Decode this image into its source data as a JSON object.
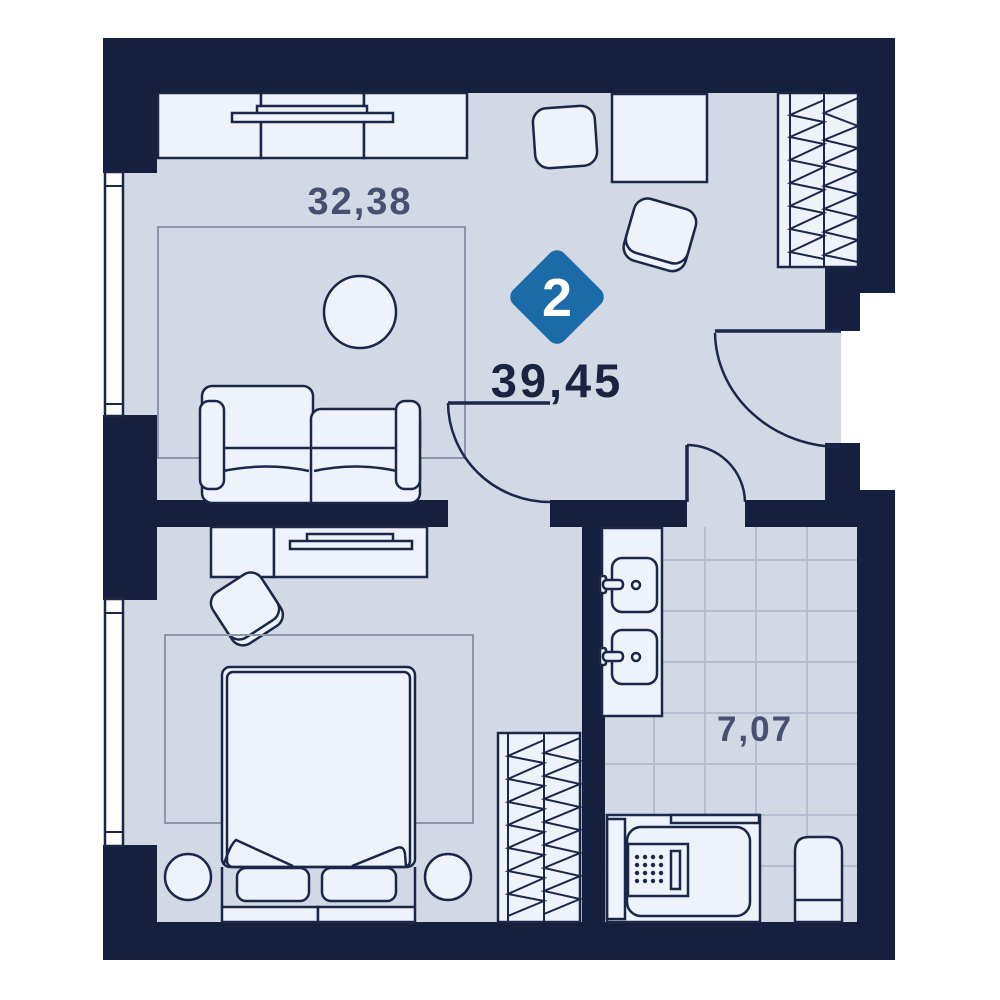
{
  "plan": {
    "rooms_badge": "2",
    "total_area": "39,45",
    "rooms": [
      {
        "name": "living-room",
        "area": "32,38"
      },
      {
        "name": "bathroom",
        "area": "7,07"
      }
    ],
    "colors": {
      "wall": "#15203e",
      "floor": "#d3d8e5",
      "furniture": "#eef2fb",
      "stroke": "#1b2748",
      "badge": "#1a6ba8",
      "total_label": "#1a2340",
      "room_label": "#47516f",
      "tile": "#b6bdd0",
      "rug_border": "#8d96ae",
      "window": "#ffffff",
      "page": "#ffffff"
    }
  }
}
